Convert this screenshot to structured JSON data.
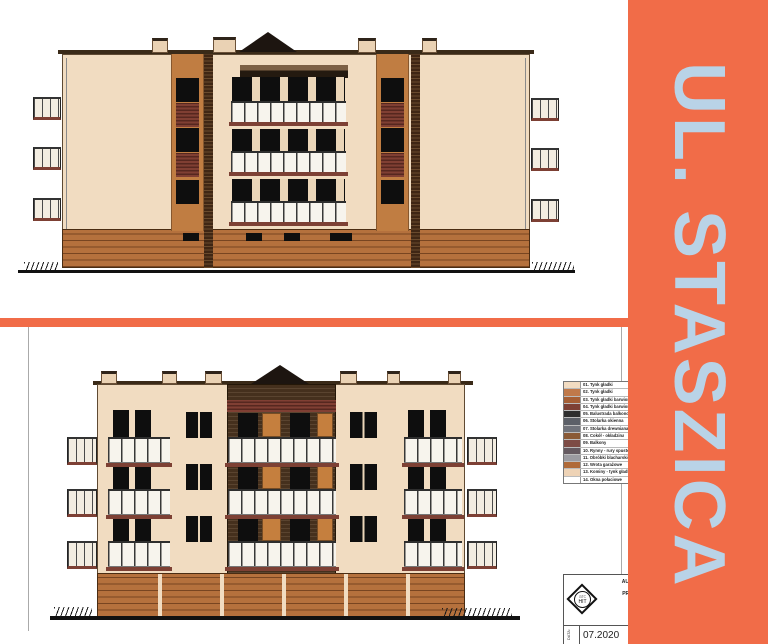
{
  "banner": {
    "title": "UL. STASZICA"
  },
  "legend": {
    "items": [
      {
        "label": "01. Tynk gładki",
        "color": "#f2dcc2"
      },
      {
        "label": "02. Tynk gładki",
        "color": "#c0794a"
      },
      {
        "label": "03. Tynk gładki barwiony",
        "color": "#a65f35"
      },
      {
        "label": "04. Tynk gładki barwiony",
        "color": "#7d4034"
      },
      {
        "label": "05. Balustrada balkonowa",
        "color": "#2e2e2e"
      },
      {
        "label": "06. Stolarka okienna",
        "color": "#5c6068"
      },
      {
        "label": "07. Stolarka drewniana",
        "color": "#70737b"
      },
      {
        "label": "08. Cokół - okładzina",
        "color": "#8a5a36"
      },
      {
        "label": "09. Balkony",
        "color": "#7d4b45"
      },
      {
        "label": "10. Rynny - rury spustowe",
        "color": "#655a61"
      },
      {
        "label": "11. Obróbki blacharskie",
        "color": "#9b9ba1"
      },
      {
        "label": "12. Wrota garażowe",
        "color": "#b06a38"
      },
      {
        "label": "13. Kominy - tynk gładki",
        "color": "#eed3b6"
      },
      {
        "label": "14. Okna połaciowe",
        "color": "#ffffff"
      }
    ]
  },
  "title_block": {
    "logo_line1": "arc",
    "logo_line2": "HIT",
    "firm_lines": [
      "AUTORSKA",
      "UL",
      "PRACOWNI",
      "TEL.:"
    ],
    "date_label": "DATA:",
    "date_value": "07.2020"
  },
  "palette": {
    "accent": "#f16c48",
    "banner_text": "#b9d3e7",
    "wall": "#f1dcc1",
    "wall_line": "#5f4a33",
    "brick": "#c07d42",
    "base": "#b5713d",
    "window": "#0e0e0e",
    "mullion": "#ead5b8",
    "louver1": "#803f33",
    "louver2": "#56271f",
    "slab": "#7d4034",
    "wood": "#45301d",
    "panel": "#c57f3e",
    "railing_bg": "#f7f4ed",
    "railing_post": "#383838",
    "chimney": "#ead2b4",
    "glass": "#f3ede1",
    "ground": "#111111"
  }
}
